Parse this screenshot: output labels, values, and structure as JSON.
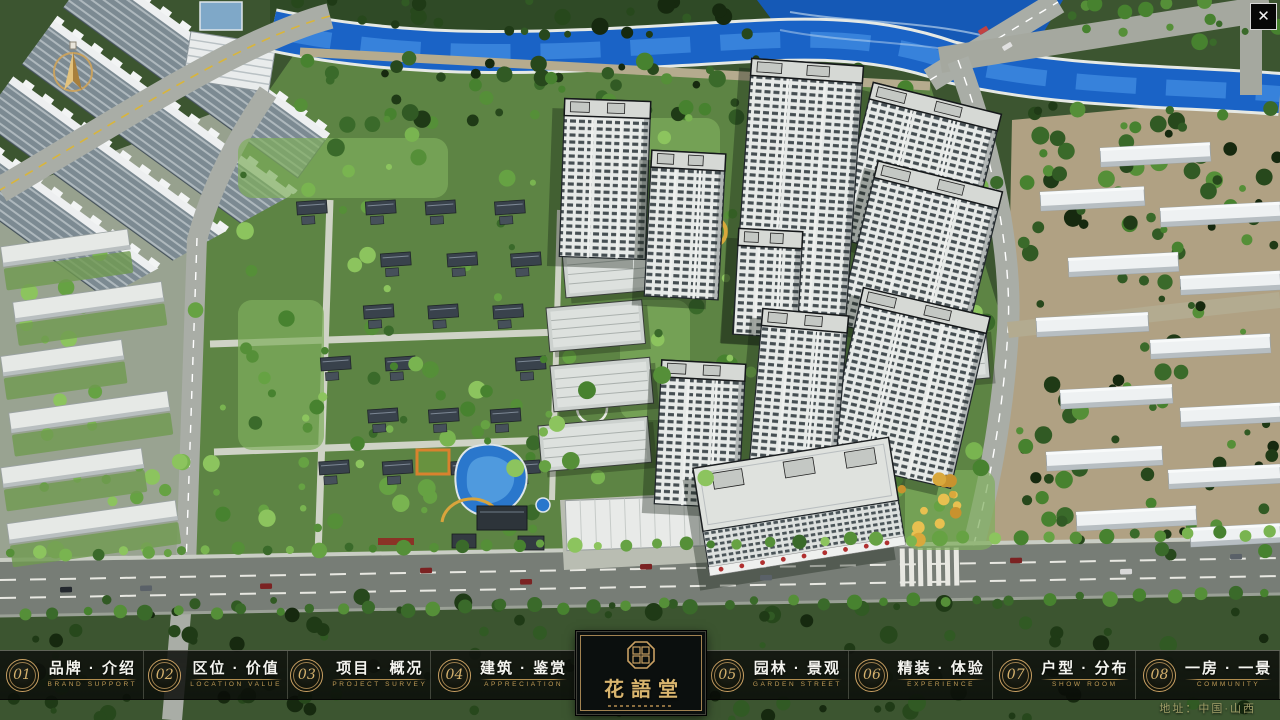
{
  "window": {
    "close_icon": "✕"
  },
  "nav": {
    "items": [
      {
        "num": "01",
        "label": "品牌 · 介绍",
        "sub": "BRAND SUPPORT"
      },
      {
        "num": "02",
        "label": "区位 · 价值",
        "sub": "LOCATION VALUE"
      },
      {
        "num": "03",
        "label": "项目 · 概况",
        "sub": "PROJECT SURVEY"
      },
      {
        "num": "04",
        "label": "建筑 · 鉴赏",
        "sub": "APPRECIATION"
      },
      {
        "num": "05",
        "label": "园林 · 景观",
        "sub": "GARDEN STREET"
      },
      {
        "num": "06",
        "label": "精装 · 体验",
        "sub": "EXPERIENCE"
      },
      {
        "num": "07",
        "label": "户型 · 分布",
        "sub": "SHOW ROOM"
      },
      {
        "num": "08",
        "label": "一房 · 一景",
        "sub": "COMMUNITY"
      }
    ]
  },
  "logo": {
    "title": "花語堂"
  },
  "footer": {
    "address": "地址：中国·山西"
  },
  "colors": {
    "gold": "#c9a063",
    "river_blue": "#1a63c6",
    "nav_bg": "#0b0e0b"
  }
}
